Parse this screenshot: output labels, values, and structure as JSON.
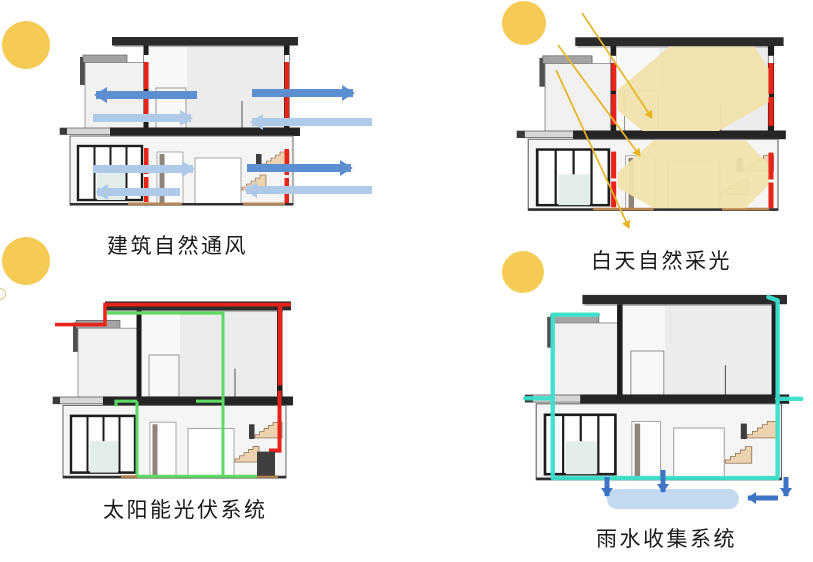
{
  "infographic": {
    "title_present": false,
    "background": "#ffffff",
    "panels": [
      {
        "id": "natural-ventilation",
        "caption": "建筑自然通风",
        "theme_color": "#5C8FD2",
        "icons": [
          "sun-icon",
          "airflow-arrow-icon",
          "window-marker"
        ]
      },
      {
        "id": "daylighting",
        "caption": "白天自然采光",
        "theme_color": "#E9B424",
        "icons": [
          "sun-icon",
          "sunlight-ray-icon",
          "daylight-glow",
          "window-marker"
        ]
      },
      {
        "id": "solar-pv",
        "caption": "太阳能光伏系统",
        "theme_color": "#5FD964",
        "icons": [
          "sun-icon",
          "pv-supply-line",
          "pv-return-line"
        ]
      },
      {
        "id": "rainwater-collection",
        "caption": "雨水收集系统",
        "theme_color": "#3BE0CE",
        "icons": [
          "sun-icon",
          "rain-pipe-line",
          "water-flow-arrow-icon",
          "water-tank"
        ]
      }
    ],
    "colors": {
      "sun": "#F5CB55",
      "airflow_strong": "#5C8FD2",
      "airflow_soft": "#AFCAE9",
      "sunlight_ray": "#E9B424",
      "daylight_glow": "#F0E3AC",
      "pv_supply_red": "#E8231A",
      "pv_return_green": "#5FD964",
      "rain_pipe_cyan": "#3BE0CE",
      "rain_water_blue": "#3E74C4",
      "water_tank": "#C3DAF1",
      "roof": "#2B2B2B",
      "window_marker_red": "#E8231A",
      "stair_wood": "#ECD2AE"
    }
  }
}
